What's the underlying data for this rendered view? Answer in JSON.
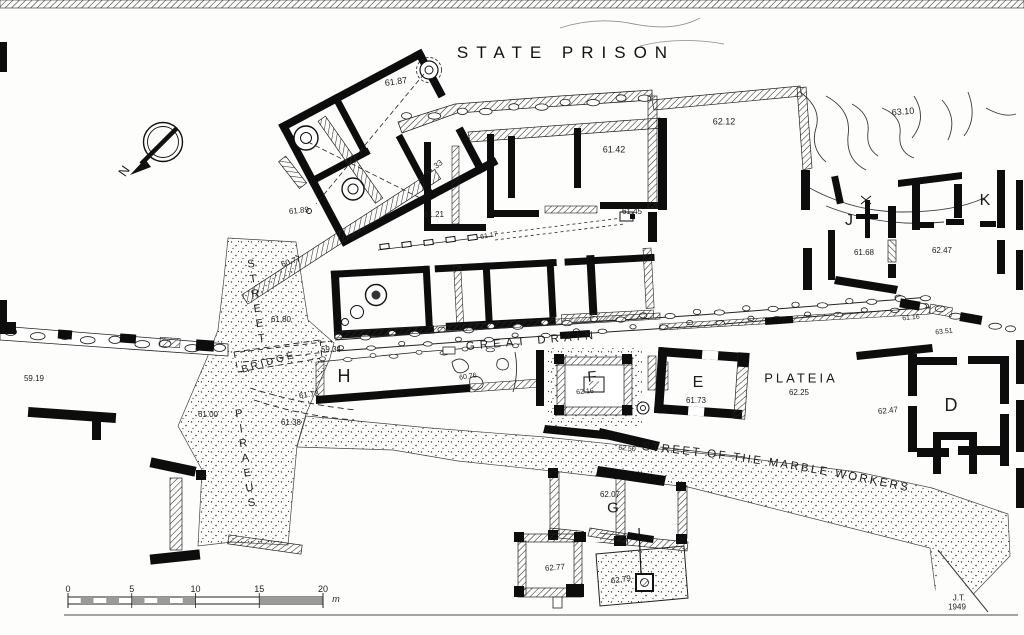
{
  "title": "STATE PRISON",
  "compass": {
    "label": "N"
  },
  "scale_bar": {
    "ticks": [
      "0",
      "5",
      "10",
      "15",
      "20"
    ],
    "unit": "m"
  },
  "signature": {
    "initials": "J.T.",
    "year": "1949"
  },
  "street_names": {
    "marble": "STREET OF THE MARBLE WORKERS"
  },
  "labels": [
    {
      "name": "elev-61-87",
      "text": "61.87",
      "x": 396,
      "y": 82,
      "rot": -8,
      "size": 9
    },
    {
      "name": "elev-61-89",
      "text": "61.89",
      "x": 299,
      "y": 211,
      "rot": -6,
      "size": 8
    },
    {
      "name": "elev-61-33",
      "text": "61.33",
      "x": 434,
      "y": 168,
      "rot": -36,
      "size": 8
    },
    {
      "name": "elev-61-21",
      "text": "61.21",
      "x": 434,
      "y": 215,
      "rot": 0,
      "size": 8
    },
    {
      "name": "elev-61-42",
      "text": "61.42",
      "x": 614,
      "y": 150,
      "rot": 0,
      "size": 9
    },
    {
      "name": "elev-61-45",
      "text": "61.45",
      "x": 632,
      "y": 212,
      "rot": 0,
      "size": 8
    },
    {
      "name": "elev-61-17",
      "text": "61.17",
      "x": 489,
      "y": 236,
      "rot": -10,
      "size": 7
    },
    {
      "name": "elev-62-12",
      "text": "62.12",
      "x": 724,
      "y": 122,
      "rot": 0,
      "size": 9
    },
    {
      "name": "elev-63-10",
      "text": "63.10",
      "x": 903,
      "y": 112,
      "rot": -5,
      "size": 9
    },
    {
      "name": "room-j",
      "text": "J",
      "x": 849,
      "y": 221,
      "rot": 0,
      "size": 16
    },
    {
      "name": "elev-61-68",
      "text": "61.68",
      "x": 864,
      "y": 253,
      "rot": 0,
      "size": 8
    },
    {
      "name": "room-k",
      "text": "K",
      "x": 985,
      "y": 201,
      "rot": 0,
      "size": 16
    },
    {
      "name": "elev-62-47-k",
      "text": "62.47",
      "x": 942,
      "y": 251,
      "rot": 0,
      "size": 8
    },
    {
      "name": "elev-60-77",
      "text": "60.77",
      "x": 291,
      "y": 262,
      "rot": -18,
      "size": 8
    },
    {
      "name": "elev-61-80",
      "text": "61.80",
      "x": 281,
      "y": 320,
      "rot": 0,
      "size": 8
    },
    {
      "name": "elev-59-34",
      "text": "59.34",
      "x": 331,
      "y": 350,
      "rot": 0,
      "size": 8
    },
    {
      "name": "great-drain",
      "text": "GREAT DRAIN",
      "x": 532,
      "y": 342,
      "rot": -5,
      "size": 11.5,
      "ls": 5
    },
    {
      "name": "room-h",
      "text": "H",
      "x": 344,
      "y": 376,
      "rot": 0,
      "size": 18
    },
    {
      "name": "elev-61-73-h",
      "text": "61.73",
      "x": 309,
      "y": 395,
      "rot": -8,
      "size": 8
    },
    {
      "name": "elev-60-76",
      "text": "60.76",
      "x": 468,
      "y": 377,
      "rot": -8,
      "size": 7
    },
    {
      "name": "room-f",
      "text": "F",
      "x": 592,
      "y": 377,
      "rot": -5,
      "size": 15
    },
    {
      "name": "elev-62-16",
      "text": "62.16",
      "x": 585,
      "y": 392,
      "rot": -5,
      "size": 7
    },
    {
      "name": "room-e",
      "text": "E",
      "x": 698,
      "y": 383,
      "rot": 0,
      "size": 16
    },
    {
      "name": "elev-61-73-e",
      "text": "61.73",
      "x": 696,
      "y": 401,
      "rot": 0,
      "size": 8
    },
    {
      "name": "plateia",
      "text": "PLATEIA",
      "x": 801,
      "y": 378,
      "rot": 0,
      "size": 13,
      "ls": 3
    },
    {
      "name": "elev-62-25",
      "text": "62.25",
      "x": 799,
      "y": 393,
      "rot": 0,
      "size": 8
    },
    {
      "name": "elev-62-47-d",
      "text": "62.47",
      "x": 888,
      "y": 411,
      "rot": -6,
      "size": 8
    },
    {
      "name": "room-d",
      "text": "D",
      "x": 951,
      "y": 405,
      "rot": 0,
      "size": 18
    },
    {
      "name": "elev-61-16",
      "text": "61.16",
      "x": 911,
      "y": 318,
      "rot": -6,
      "size": 7
    },
    {
      "name": "elev-63-51",
      "text": "63.51",
      "x": 944,
      "y": 332,
      "rot": -6,
      "size": 7
    },
    {
      "name": "elev-62-50",
      "text": "62.50",
      "x": 627,
      "y": 449,
      "rot": 6,
      "size": 7
    },
    {
      "name": "room-g",
      "text": "G",
      "x": 613,
      "y": 508,
      "rot": 0,
      "size": 15
    },
    {
      "name": "elev-62-07",
      "text": "62.07",
      "x": 610,
      "y": 495,
      "rot": 0,
      "size": 8
    },
    {
      "name": "elev-62-77",
      "text": "62.77",
      "x": 555,
      "y": 568,
      "rot": -5,
      "size": 8
    },
    {
      "name": "elev-62-79",
      "text": "62.79",
      "x": 621,
      "y": 580,
      "rot": -8,
      "size": 8
    },
    {
      "name": "elev-61-38",
      "text": "61.38",
      "x": 291,
      "y": 423,
      "rot": 0,
      "size": 8
    },
    {
      "name": "elev-61-00",
      "text": "61.00",
      "x": 208,
      "y": 415,
      "rot": 0,
      "size": 8
    },
    {
      "name": "elev-59-19",
      "text": "59.19",
      "x": 34,
      "y": 379,
      "rot": 0,
      "size": 8
    },
    {
      "name": "street-piraeus",
      "text": "PIRAEUS",
      "x": 245,
      "y": 460,
      "rot": -8,
      "size": 11,
      "ls": 3,
      "vertical": true
    },
    {
      "name": "street-street",
      "text": "STREET",
      "x": 256,
      "y": 303,
      "rot": -8,
      "size": 11,
      "ls": 3,
      "vertical": true
    },
    {
      "name": "bridge",
      "text": "BRIDGE",
      "x": 269,
      "y": 363,
      "rot": -16,
      "size": 10,
      "ls": 3
    }
  ]
}
